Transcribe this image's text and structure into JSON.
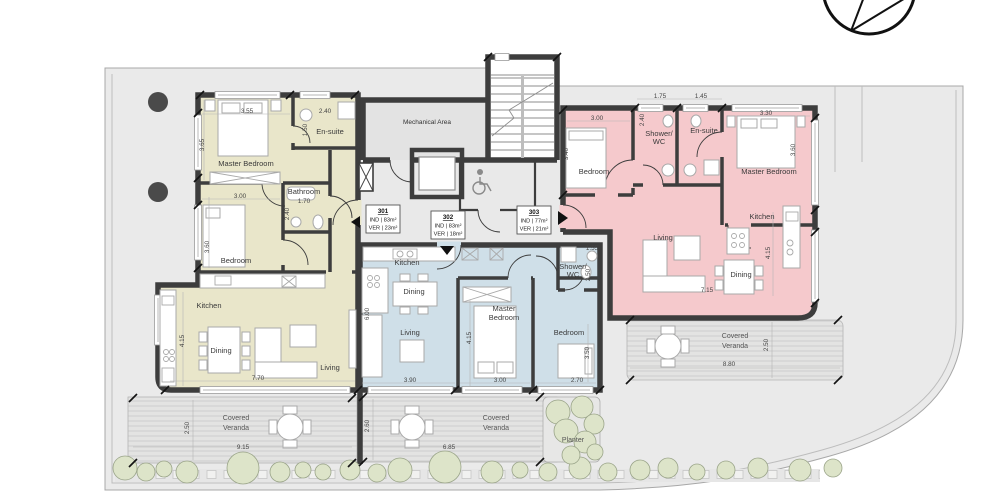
{
  "colors": {
    "apt301": "#e9e6ca",
    "apt302": "#cfdfe8",
    "apt303": "#f5c9cc",
    "wall": "#3d3d3d",
    "bush": "#dde4c9",
    "site": "#eaeaea"
  },
  "core": {
    "mechanical": "Mechanical Area"
  },
  "units": {
    "u301": {
      "id": "301",
      "ind": "IND | 83m²",
      "ver": "VER | 23m²",
      "labels": {
        "master": "Master Bedroom",
        "ensuite": "En-suite",
        "bathroom": "Bathroom",
        "bedroom": "Bedroom",
        "kitchen": "Kitchen",
        "dining": "Dining",
        "living": "Living"
      },
      "dims": {
        "master_w": "3.55",
        "master_h": "3.65",
        "ensuite_w": "2.40",
        "ensuite_h": "1.50",
        "bathroom_w": "1.70",
        "bathroom_h": "2.40",
        "bedroom_w": "3.00",
        "bedroom_h": "3.60",
        "living_w": "7.70",
        "kitchen_h": "4.15"
      }
    },
    "u302": {
      "id": "302",
      "ind": "IND | 83m²",
      "ver": "VER | 18m²",
      "labels": {
        "kitchen": "Kitchen",
        "dining": "Dining",
        "living": "Living",
        "master1": "Master",
        "master2": "Bedroom",
        "bedroom": "Bedroom",
        "shower1": "Shower/",
        "shower2": "WC"
      },
      "dims": {
        "left_h": "6.00",
        "living_w": "3.90",
        "master_w": "3.00",
        "master_h": "4.15",
        "bedroom_w": "2.70",
        "bedroom_h": "3.50",
        "shower_w": "1.55",
        "shower_h": "2.50"
      }
    },
    "u303": {
      "id": "303",
      "ind": "IND | 77m²",
      "ver": "VER | 21m²",
      "labels": {
        "bedroom": "Bedroom",
        "shower1": "Shower/",
        "shower2": "WC",
        "ensuite": "En-suite",
        "master": "Master Bedroom",
        "living": "Living",
        "dining": "Dining",
        "kitchen": "Kitchen"
      },
      "dims": {
        "bedroom_w": "3.00",
        "bedroom_h": "3.40",
        "shower_w": "1.75",
        "shower_h": "2.40",
        "ensuite_w": "1.45",
        "master_w": "3.30",
        "master_h": "3.60",
        "living_w": "7.15",
        "living_h": "4.15"
      }
    }
  },
  "verandas": {
    "left": {
      "line1": "Covered",
      "line2": "Veranda",
      "w": "9.15",
      "h": "2.50"
    },
    "center": {
      "line1": "Covered",
      "line2": "Veranda",
      "w": "6.85",
      "h": "2.60"
    },
    "right": {
      "line1": "Covered",
      "line2": "Veranda",
      "w": "8.80",
      "h": "2.50"
    },
    "planter": "Planter"
  }
}
